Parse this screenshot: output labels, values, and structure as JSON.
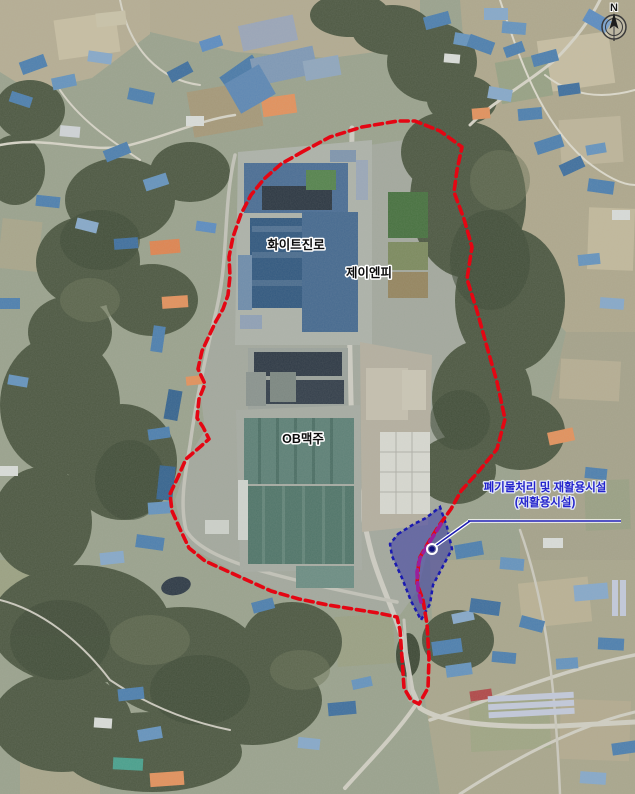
{
  "map": {
    "compass_label": "N",
    "site_labels": {
      "hite": "화이트진로",
      "jnp": "제이엔피",
      "ob": "OB맥주"
    },
    "annotation": {
      "line1": "폐기물처리 및 재활용시설",
      "line2": "(재활용시설)"
    },
    "colors": {
      "boundary_red": "#e40613",
      "overlap_purple": "#9b1f9b",
      "site_fill_blue": "#2d2da5",
      "site_stroke_blue": "#1b1bb0",
      "annotation_blue": "#2222cc"
    }
  }
}
